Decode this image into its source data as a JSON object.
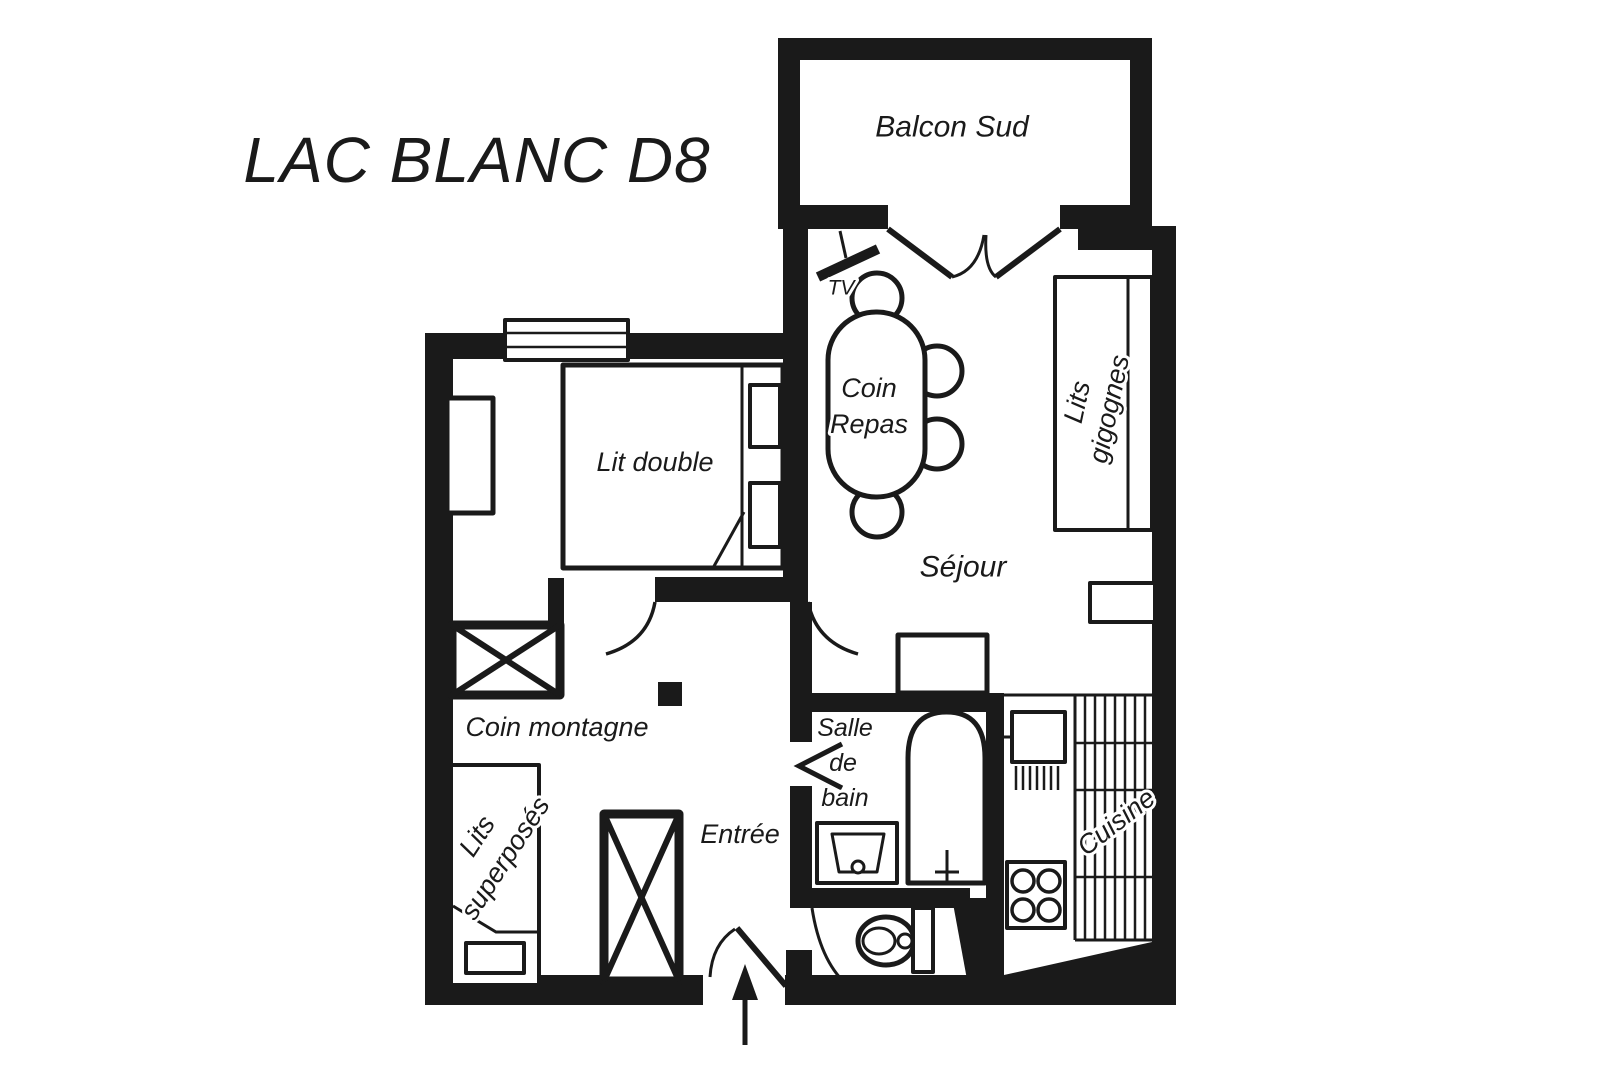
{
  "title": "LAC BLANC D8",
  "labels": {
    "balcony": "Balcon Sud",
    "living_room": "Séjour",
    "dining_1": "Coin",
    "dining_2": "Repas",
    "double_bed": "Lit double",
    "mountain_corner": "Coin montagne",
    "entrance": "Entrée",
    "bathroom_1": "Salle",
    "bathroom_2": "de",
    "bathroom_3": "bain",
    "kitchen": "Cuisine",
    "tv": "TV",
    "trundle_1": "Lits",
    "trundle_2": "gigognes",
    "bunk_1": "Lits",
    "bunk_2": "superposés"
  },
  "colors": {
    "ink": "#1a1a1a",
    "background": "#ffffff"
  }
}
